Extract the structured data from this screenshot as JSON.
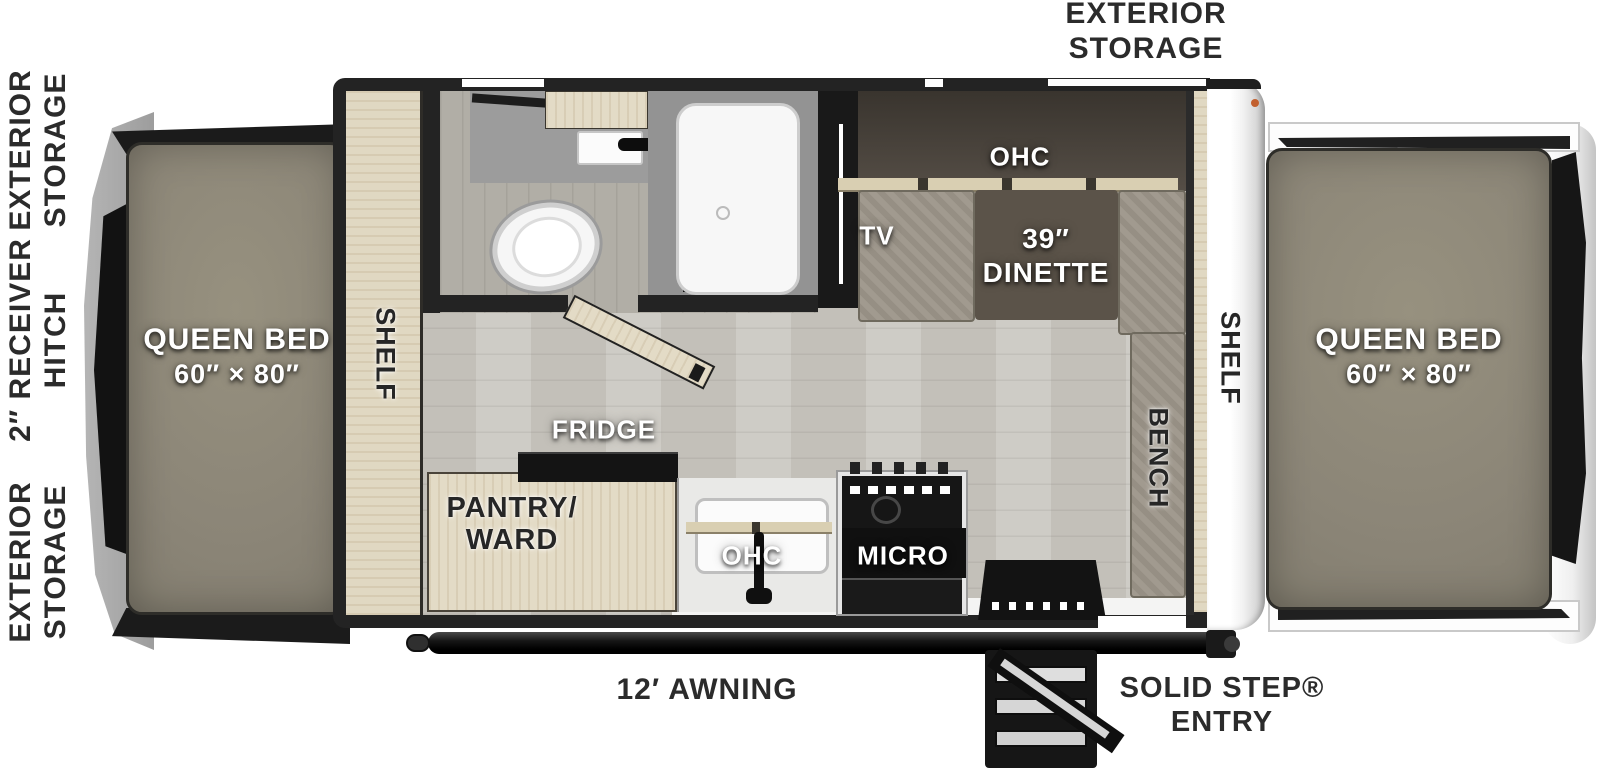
{
  "title": "Expandable travel trailer floor plan",
  "exterior": {
    "left_labels": [
      "EXTERIOR\nSTORAGE",
      "2″ RECEIVER\nHITCH",
      "EXTERIOR\nSTORAGE"
    ],
    "top_label": "EXTERIOR\nSTORAGE",
    "awning": "12′ AWNING",
    "entry": "SOLID STEP®\nENTRY"
  },
  "beds": {
    "front": {
      "name": "QUEEN BED",
      "size": "60″ × 80″"
    },
    "rear": {
      "name": "QUEEN BED",
      "size": "60″ × 80″"
    }
  },
  "interior": {
    "front_shelf": "SHELF",
    "rear_shelf": "SHELF",
    "bench": "BENCH",
    "tv": "TV",
    "dinette_ohc": "OHC",
    "dinette": "39″\nDINETTE",
    "fridge": "FRIDGE",
    "pantry": "PANTRY/\nWARD",
    "kitchen_ohc": "OHC",
    "micro": "MICRO"
  },
  "colors": {
    "wall": "#232323",
    "floor": "#c9c6bf",
    "bath_floor": "#b1aea6",
    "wood": "#e3dbc6",
    "cushion": "#9c9589",
    "table": "#5b5349",
    "mattress": "#8b8577",
    "rear_cap": "#f5f5f5",
    "label_light": "#ffffff",
    "label_dark": "#2b2b2b",
    "accent_dot": "#c2602f"
  }
}
